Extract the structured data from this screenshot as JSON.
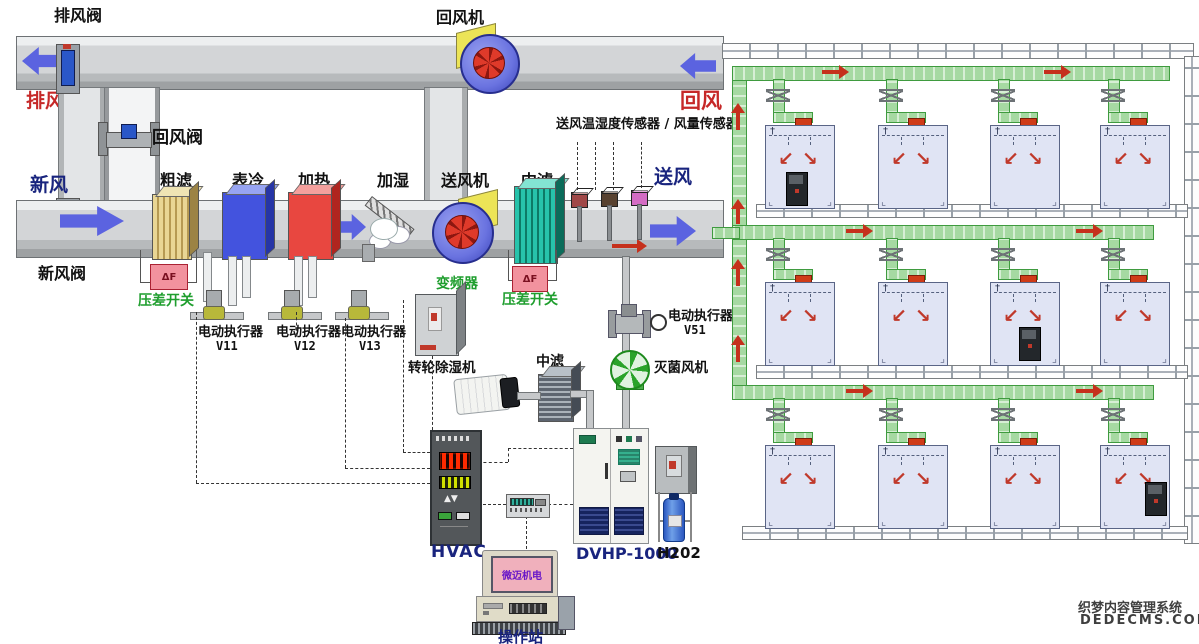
{
  "ahu": {
    "labels": {
      "exhaust_valve": "排风阀",
      "return_fan": "回风机",
      "exhaust_air": "排风",
      "return_valve": "回风阀",
      "fresh_air": "新风",
      "fresh_air_valve": "新风阀",
      "coarse_filter": "粗滤",
      "cooling_coil": "表冷",
      "heating_coil": "加热",
      "humidifier": "加湿",
      "supply_fan": "送风机",
      "mid_filter": "中滤",
      "sensor_group": "送风温湿度传感器 / 风量传感器",
      "supply_air": "送风",
      "return_air": "回风"
    }
  },
  "field_devices": {
    "dp_switch_label": "压差开关",
    "dp_tag": "ΔF",
    "actuator_label": "电动执行器",
    "v11": "V11",
    "v12": "V12",
    "v13": "V13",
    "v51": "V51",
    "inverter": "变频器",
    "rotary_dehumidifier": "转轮除湿机",
    "mid_filter_2": "中滤",
    "sterilizing_fan": "灭菌风机"
  },
  "equipment": {
    "hvac_controller": "HVAC",
    "dvhp_cabinet": "DVHP-1000",
    "h2o2_unit": "H202",
    "operator_station": "操作站",
    "monitor_screen": "微迈机电"
  },
  "rooms": {
    "rows": 3,
    "cols": 4,
    "ceiling_mark": "†",
    "airflow_left_icon": "↙",
    "airflow_right_icon": "↘",
    "corner_left_icon": "⌞",
    "corner_right_icon": "⌟",
    "equipment_rooms": [
      {
        "row": 0,
        "col": 0
      },
      {
        "row": 1,
        "col": 2
      },
      {
        "row": 2,
        "col": 3
      }
    ]
  },
  "watermark": {
    "line1": "织梦内容管理系统",
    "line2": "DEDECMS.COM"
  },
  "colors": {
    "supply_duct_green": "#a6d9a2",
    "flow_arrow_red": "#c5301c",
    "air_arrow_blue": "#5b63e0",
    "room_fill": "#e0e4f4",
    "dp_switch_pink": "#f2929e"
  }
}
